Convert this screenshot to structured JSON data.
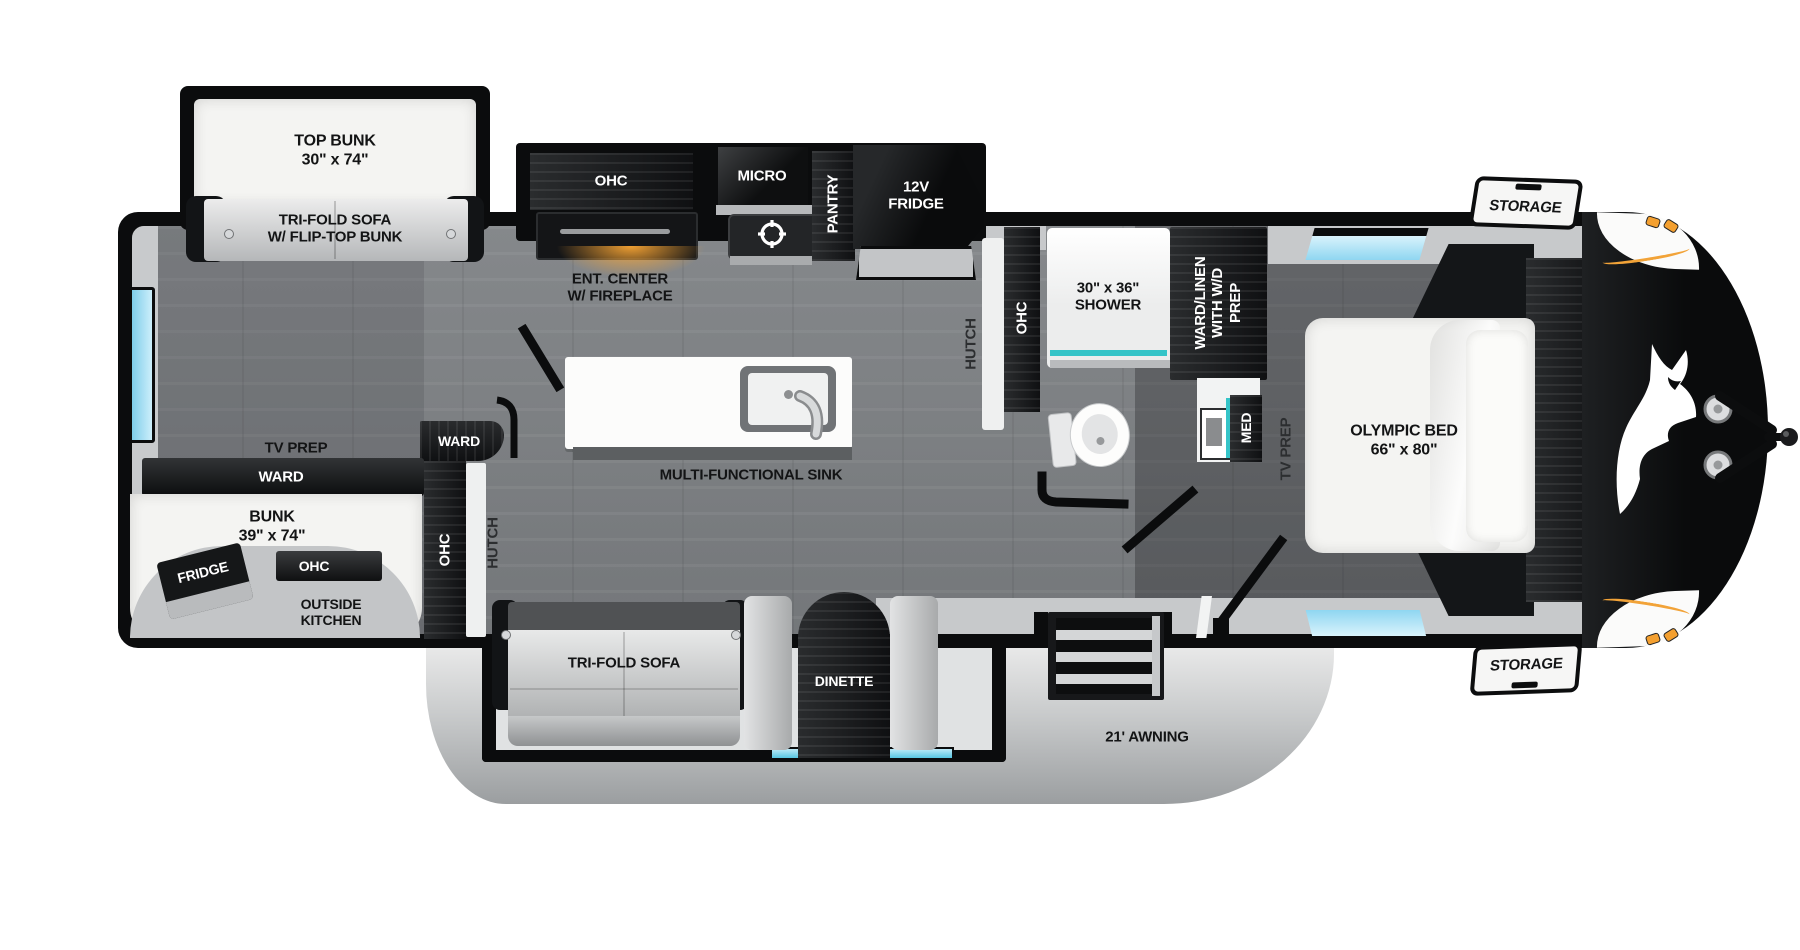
{
  "colors": {
    "wall_black": "#0b0c0d",
    "floor_gray": "#7e8184",
    "accent_teal": "#35c4c8",
    "window_blue": "#9fdcf4",
    "accent_orange": "#f2a338",
    "awning_gray": "#c9cbcc"
  },
  "rear_bedroom": {
    "top_bunk": "TOP BUNK\n30\" x 74\"",
    "trifold_sofa": "TRI-FOLD SOFA\nW/ FLIP-TOP BUNK",
    "tv_prep": "TV PREP",
    "ward": "WARD",
    "bunk": "BUNK\n39\" x 74\"",
    "outside_kitchen": "OUTSIDE\nKITCHEN",
    "outside_fridge": "FRIDGE",
    "outside_ohc": "OHC",
    "mid_ward": "WARD",
    "mid_ohc": "OHC",
    "mid_hutch": "HUTCH"
  },
  "kitchen": {
    "ohc": "OHC",
    "ent_center": "ENT. CENTER\nW/ FIREPLACE",
    "micro": "MICRO",
    "pantry": "PANTRY",
    "fridge_12v": "12V\nFRIDGE",
    "island_sink": "MULTI-FUNCTIONAL SINK"
  },
  "bathroom": {
    "hutch": "HUTCH",
    "ohc": "OHC",
    "shower": "30\" x 36\"\nSHOWER",
    "ward_linen": "WARD/LINEN\nWITH W/D\nPREP",
    "med": "MED"
  },
  "bedroom": {
    "bed": "OLYMPIC BED\n66\" x 80\"",
    "tv_prep": "TV PREP"
  },
  "living": {
    "trifold_sofa": "TRI-FOLD SOFA",
    "dinette": "DINETTE"
  },
  "exterior": {
    "storage_top": "STORAGE",
    "storage_bottom": "STORAGE",
    "awning": "21' AWNING"
  }
}
